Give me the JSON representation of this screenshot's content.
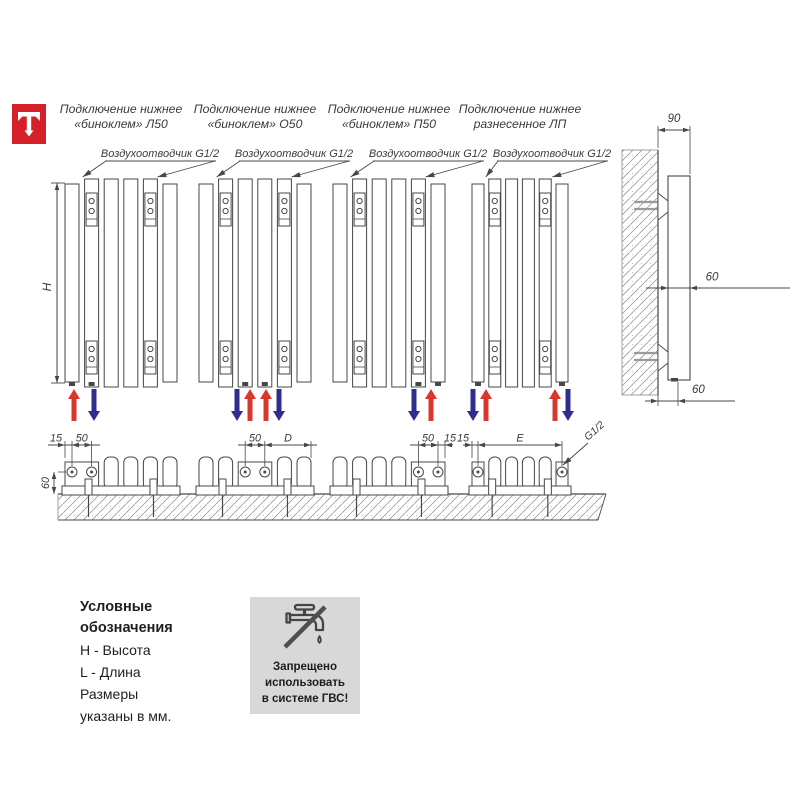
{
  "brand": {
    "logo_color": "#d52029"
  },
  "diagram": {
    "radiators": [
      {
        "title_line1": "Подключение нижнее",
        "title_line2": "«биноклем» Л50"
      },
      {
        "title_line1": "Подключение нижнее",
        "title_line2": "«биноклем» О50"
      },
      {
        "title_line1": "Подключение нижнее",
        "title_line2": "«биноклем» П50"
      },
      {
        "title_line1": "Подключение нижнее",
        "title_line2": "разнесенное ЛП"
      }
    ],
    "air_vent_label": "Воздухоотводчик G1/2",
    "height_dim_label": "H",
    "thread_label": "G1/2",
    "floor_height_dim": "60",
    "bottom_dims": [
      [
        "15",
        "50"
      ],
      [
        "50",
        "D"
      ],
      [
        "50",
        "15"
      ],
      [
        "15",
        "E"
      ]
    ],
    "side_view_dims": {
      "bracket_offset": "90",
      "depth": "60",
      "bottom_offset": "60"
    },
    "flow_colors": {
      "supply": "#d8382c",
      "return": "#2f2d8e"
    },
    "flow_arrows": [
      [
        {
          "x": 74,
          "dir": "up",
          "flow": "supply"
        },
        {
          "x": 94,
          "dir": "down",
          "flow": "return"
        }
      ],
      [
        {
          "x": 237,
          "dir": "down",
          "flow": "return"
        },
        {
          "x": 250,
          "dir": "up",
          "flow": "supply"
        },
        {
          "x": 266,
          "dir": "up",
          "flow": "supply"
        },
        {
          "x": 279,
          "dir": "down",
          "flow": "return"
        }
      ],
      [
        {
          "x": 414,
          "dir": "down",
          "flow": "return"
        },
        {
          "x": 431,
          "dir": "up",
          "flow": "supply"
        }
      ],
      [
        {
          "x": 473,
          "dir": "down",
          "flow": "return"
        },
        {
          "x": 486,
          "dir": "up",
          "flow": "supply"
        },
        {
          "x": 555,
          "dir": "up",
          "flow": "supply"
        },
        {
          "x": 568,
          "dir": "down",
          "flow": "return"
        }
      ]
    ]
  },
  "legend": {
    "title": [
      "Условные",
      "обозначения"
    ],
    "lines": [
      "H - Высота",
      "L - Длина",
      "Размеры",
      "указаны в мм."
    ]
  },
  "warning": {
    "bg": "#d8d8d8",
    "lines": [
      "Запрещено",
      "использовать",
      "в системе ГВС!"
    ]
  }
}
